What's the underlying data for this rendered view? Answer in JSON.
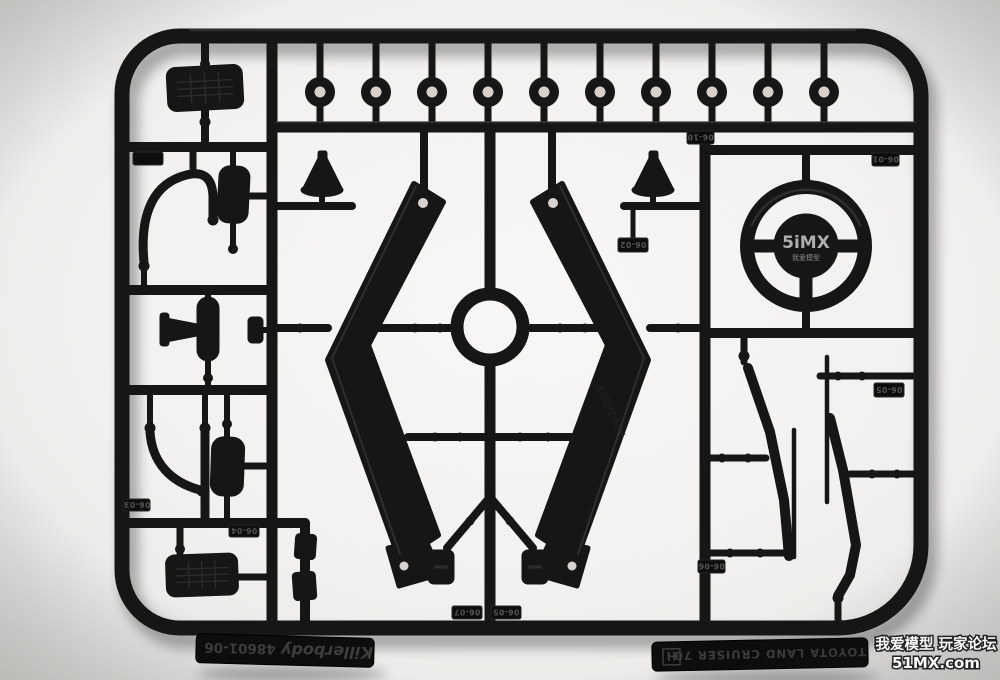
{
  "meta": {
    "type": "photograph",
    "description": "Top-down photo of a black injection-molded plastic parts sprue (runner H) from a Killerbody Toyota Land Cruiser 70 RC body kit, on a bright white studio background"
  },
  "colors": {
    "background": "#f2f1ef",
    "background_center": "#f8f7f5",
    "plastic": "#161616",
    "tab_plastic": "#0d0d0d",
    "embossed_text": "#3d3d3d",
    "tag_text": "#555555",
    "hole_through": "#d8d3cc",
    "watermark_fill": "#fdfdfd",
    "watermark_outline": "#1a1a1a",
    "hub_watermark": "#c9c9c9"
  },
  "sprue": {
    "brand_tab": {
      "brand": "Killerbody",
      "part_number": "48601-06"
    },
    "model_tab": {
      "model": "TOYOTA LAND CRUISER 70",
      "sprue_letter": "H"
    },
    "bar_embossed_text": "Killerbody",
    "part_tags": [
      {
        "label": "06-10"
      },
      {
        "label": "06-01"
      },
      {
        "label": "06-02"
      },
      {
        "label": "06-04"
      },
      {
        "label": "06-03"
      },
      {
        "label": "06-07"
      },
      {
        "label": "06-05"
      },
      {
        "label": "06-05"
      },
      {
        "label": "06-06"
      }
    ],
    "parts": [
      {
        "id": "grommet-washer",
        "label": "round grommet washers",
        "qty": 10
      },
      {
        "id": "pedal-pad",
        "label": "ribbed pedal / step pads",
        "qty": 2
      },
      {
        "id": "grab-handle",
        "label": "bent tube grab handles",
        "qty": 2
      },
      {
        "id": "small-box",
        "label": "rounded box covers",
        "qty": 2
      },
      {
        "id": "side-mirror",
        "label": "side mirror with mount",
        "qty": 1
      },
      {
        "id": "cone-cover",
        "label": "cone-shaped covers",
        "qty": 2
      },
      {
        "id": "pillar-bar",
        "label": "windshield / roll-bar pillars",
        "qty": 2
      },
      {
        "id": "center-ring",
        "label": "circular ring",
        "qty": 1
      },
      {
        "id": "steering-wheel",
        "label": "steering wheel",
        "qty": 1
      },
      {
        "id": "wiper-arm",
        "label": "wiper arms",
        "qty": 2
      },
      {
        "id": "wiper-blade",
        "label": "wiper blades",
        "qty": 2
      },
      {
        "id": "small-bracket",
        "label": "small brackets",
        "qty": 2
      }
    ]
  },
  "watermarks": {
    "hub": {
      "line1": "5iMX",
      "line2": "我爱模型"
    },
    "corner": {
      "line1": "我爱模型 玩家论坛",
      "line2": "51MX.com"
    }
  }
}
